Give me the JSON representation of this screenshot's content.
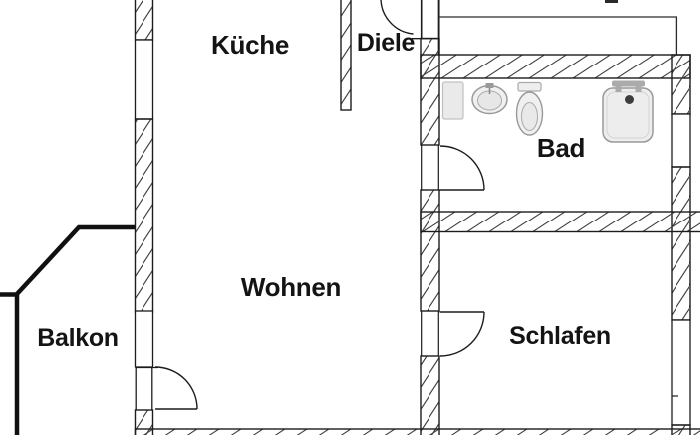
{
  "rooms": {
    "kueche": {
      "label": "Küche"
    },
    "diele": {
      "label": "Diele"
    },
    "bad": {
      "label": "Bad"
    },
    "wohnen": {
      "label": "Wohnen"
    },
    "balkon": {
      "label": "Balkon"
    },
    "schlafen": {
      "label": "Schlafen"
    }
  },
  "fixtures": {
    "cabinet": "cabinet-symbol",
    "sink": "sink-symbol",
    "toilet": "toilet-symbol",
    "shower": "shower-symbol"
  },
  "colors": {
    "wall_outline": "#1c1c1c",
    "hatch": "#3f3f3f",
    "balcony": "#111111",
    "fixture_fill": "#ececec",
    "fixture_stroke": "#9a9a9a",
    "label": "#141414",
    "background": "#ffffff"
  }
}
